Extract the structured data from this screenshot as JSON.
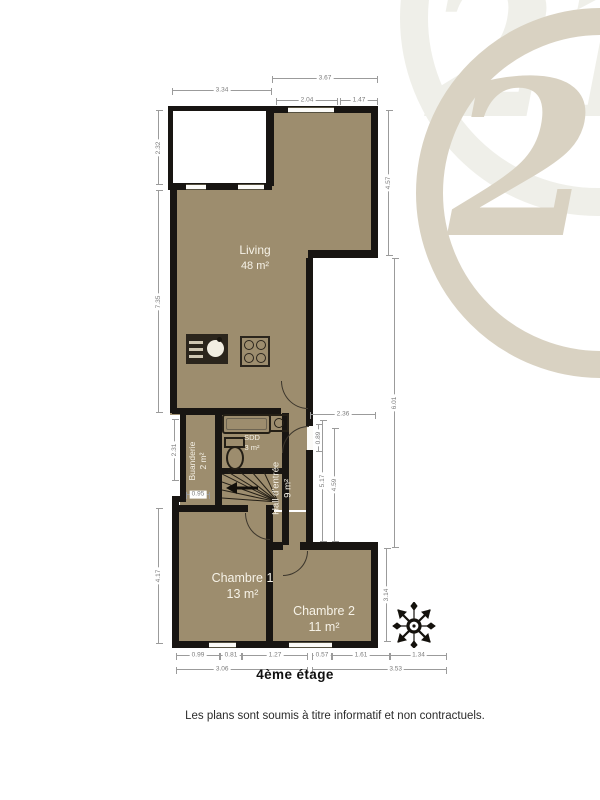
{
  "watermark": {
    "brand_number": "21"
  },
  "plan": {
    "rooms": [
      {
        "name": "Living",
        "area": "48 m²"
      },
      {
        "name": "Buanderie",
        "area": "2 m²"
      },
      {
        "name": "SDD",
        "area": "3 m²"
      },
      {
        "name": "Hall d'entrée",
        "area": "9 m²"
      },
      {
        "name": "Chambre 1",
        "area": "13 m²"
      },
      {
        "name": "Chambre 2",
        "area": "11 m²"
      }
    ],
    "dims": {
      "top_right_total": "3.67",
      "top_terrace": "3.34",
      "top_right_a": "2.04",
      "top_right_b": "1.47",
      "left_terrace": "2.32",
      "left_living": "7.35",
      "left_mid": "2.31",
      "left_notch": "0.95",
      "left_chambre1": "4.17",
      "right_living": "4.57",
      "right_void": "6.01",
      "void_width": "2.36",
      "entry_opening": "0.89",
      "void_inner_a": "4.59",
      "void_inner_b": "5.17",
      "right_chambre2": "3.14",
      "bottom_1": "0.99",
      "bottom_2": "0.81",
      "bottom_3": "1.27",
      "bottom_4": "0.57",
      "bottom_5": "1.61",
      "bottom_6": "1.34",
      "bottom_total_1": "3.06",
      "bottom_total_2": "3.53"
    },
    "colors": {
      "floor": "#9d8d6e",
      "wall": "#181512",
      "dimension": "#9b9b9b",
      "watermark_front": "#d9d2c2",
      "watermark_back": "#efefe9"
    }
  },
  "captions": {
    "floor_label": "4ème étage",
    "disclaimer": "Les plans sont soumis à titre informatif et non contractuels."
  }
}
